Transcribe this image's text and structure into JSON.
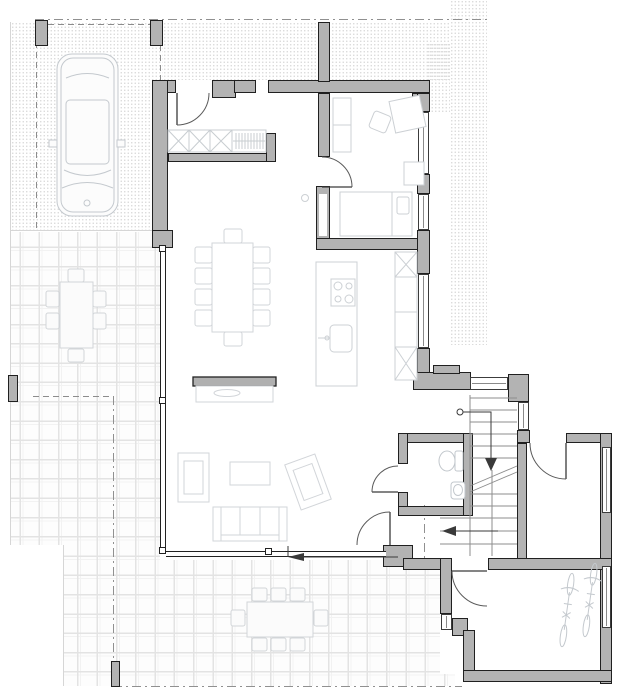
{
  "meta": {
    "title": "Ground floor architectural plan",
    "style": "monochrome CAD drawing",
    "visible_text": "none"
  },
  "palette": {
    "background": "#ffffff",
    "wall_fill": "#b3b3b3",
    "wall_outline": "#202020",
    "furniture_line": "#ccd0d4",
    "vehicle_line": "#c4c9ce",
    "fixture_line": "#c2c7cc",
    "tile_line": "#e3e3e3",
    "hatch_dot": "#d9d9d9",
    "boundary_line": "#909090",
    "door_arc": "#5a5a5a",
    "arrow": "#3a3a3a",
    "glass_line": "#8a8a8a"
  },
  "site": {
    "property_boundary": "dash-dot lines along top, left and bottom",
    "gravel_hatch_zones": [
      "carport floor",
      "north strip behind house",
      "east side band"
    ],
    "paved_terrace": "square tile grid wrapping west and south of living room"
  },
  "spaces": [
    {
      "name": "carport",
      "contents": [
        "car seen in plan view",
        "two front pillars",
        "dashed garage door line"
      ]
    },
    {
      "name": "entry-hall",
      "contents": [
        "entry door",
        "built-in wardrobe with 3 X-boxes",
        "coat rail with hangers"
      ]
    },
    {
      "name": "living-dining-kitchen",
      "contents": [
        "dining table with 10 chairs",
        "kitchen island with cooktop and sink",
        "tall cabinet run with X symbols",
        "sideboard with bowl",
        "sofa",
        "2 armchairs",
        "coffee table",
        "floor-to-ceiling glazing west and south",
        "sliding-door arrow"
      ]
    },
    {
      "name": "bedroom-office-NE",
      "contents": [
        "bed with pillow",
        "wardrobe",
        "desk",
        "swivel chair",
        "side table",
        "2 windows east"
      ]
    },
    {
      "name": "wc",
      "contents": [
        "toilet",
        "washbasin",
        "outswinging door"
      ]
    },
    {
      "name": "stair-hall",
      "contents": [
        "staircase with break line",
        "down arrow from circle",
        "left arrow on lower flight",
        "top window",
        "east window"
      ]
    },
    {
      "name": "entrance-porch",
      "contents": [
        "entrance door swing",
        "windows in far east wall"
      ]
    },
    {
      "name": "bike-storage",
      "contents": [
        "2 bicycles",
        "door from stair hall",
        "corner window"
      ]
    },
    {
      "name": "west-terrace",
      "contents": [
        "outdoor table with 6 chairs",
        "terrace pillar"
      ]
    },
    {
      "name": "south-terrace",
      "contents": [
        "outdoor table with 8 chairs",
        "corner pillar"
      ]
    }
  ],
  "counts": {
    "dining_chairs": 10,
    "west_terrace_chairs": 6,
    "south_terrace_chairs": 8,
    "bicycles": 2,
    "cars": 1,
    "door_swings": 6
  }
}
